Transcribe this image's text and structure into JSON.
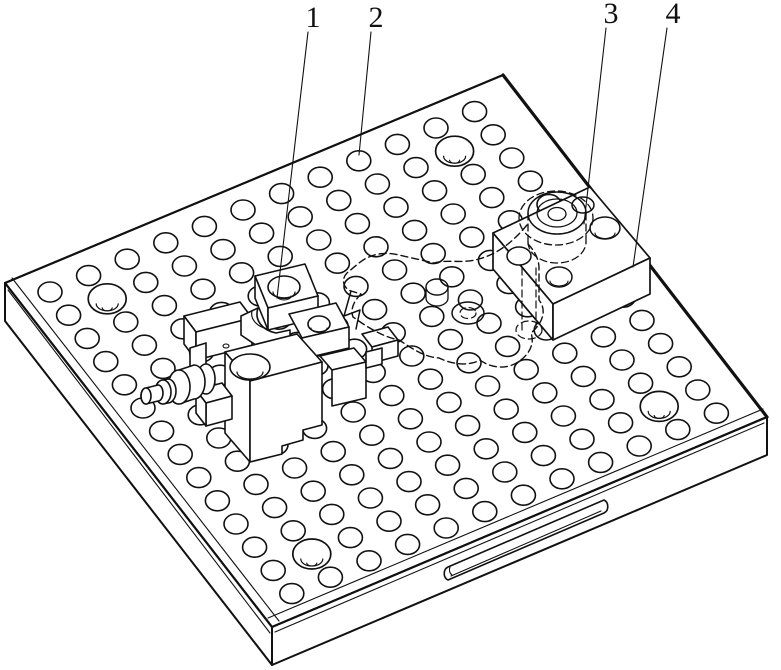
{
  "title_hidden": "",
  "colors": {
    "ink": "#111111",
    "paper": "#ffffff"
  },
  "callouts": [
    {
      "label": "1",
      "tx": 313,
      "ty": 27,
      "lx1": 308,
      "ly1": 32,
      "lx2": 277,
      "ly2": 298
    },
    {
      "label": "2",
      "tx": 376,
      "ty": 27,
      "lx1": 371,
      "ly1": 32,
      "lx2": 359,
      "ly2": 155
    },
    {
      "label": "3",
      "tx": 611,
      "ty": 23,
      "lx1": 606,
      "ly1": 28,
      "lx2": 584,
      "ly2": 224
    },
    {
      "label": "4",
      "tx": 673,
      "ty": 23,
      "lx1": 667,
      "ly1": 28,
      "lx2": 633,
      "ly2": 267
    }
  ],
  "figure": {
    "canvas": {
      "w": 781,
      "h": 670
    },
    "plate": {
      "top": [
        [
          5,
          283
        ],
        [
          503,
          75
        ],
        [
          767,
          417
        ],
        [
          272,
          627
        ]
      ],
      "bottom": [
        [
          5,
          321
        ],
        [
          272,
          665
        ],
        [
          767,
          455
        ]
      ],
      "edge_widths": {
        "lt": 2.1,
        "tr": 3.2,
        "rf": 2.1,
        "fl": 2.1
      },
      "chamfer_fl": [
        8,
        290,
        270,
        633
      ],
      "chamfer_fr": [
        275,
        632,
        764,
        423
      ],
      "inset_fl": [
        12,
        278,
        279,
        621
      ],
      "inset_fr": [
        268,
        618,
        763,
        409
      ]
    },
    "holes": {
      "origin": [
        50,
        292
      ],
      "a": [
        38.6,
        -16.4
      ],
      "c": [
        18.6,
        23.2
      ],
      "iMin": -10,
      "iMax": 13,
      "jMin": 0,
      "jMax": 13,
      "rx": 12,
      "ry": 10,
      "clip": {
        "L": [
          5,
          283
        ],
        "A": [
          498,
          -208
        ],
        "B": [
          264,
          342
        ],
        "sMin": 0.035,
        "sMax": 0.965,
        "tMin": 0.05,
        "tMax": 0.955
      },
      "large": [
        [
          1,
          1
        ],
        [
          10,
          1
        ],
        [
          1,
          12
        ],
        [
          10,
          12
        ]
      ],
      "largeRx": 19,
      "largeRy": 15
    },
    "shapes": [
      {
        "name": "side-slot-outline",
        "kind": "path",
        "d": "M448,567 L604,500 A6,7 0 0 1 604,513 L448,580 A6,7 0 0 1 448,567 Z",
        "f": "#ffffff",
        "w": 1.6
      },
      {
        "name": "side-slot-depth-line",
        "kind": "path",
        "d": "M451,576 L601,511",
        "w": 1.1
      },
      {
        "name": "side-slot-cap-arc",
        "kind": "path",
        "d": "M452,575 A5,6 0 0 1 450,567",
        "w": 1.1
      },
      {
        "name": "clamp-rear-base-top",
        "kind": "poly",
        "p": "184,316 240,302 252,318 196,332",
        "f": "#ffffff",
        "w": 1.6
      },
      {
        "name": "clamp-rear-base-left",
        "kind": "poly",
        "p": "184,316 196,332 196,360 184,344",
        "f": "#ffffff",
        "w": 1.6
      },
      {
        "name": "clamp-rear-base-front",
        "kind": "poly",
        "p": "196,332 252,318 252,346 196,360",
        "f": "#ffffff",
        "w": 1.6
      },
      {
        "name": "clamp-boss-a-top",
        "kind": "poly",
        "p": "255,276 305,264 318,296 268,308",
        "f": "#ffffff",
        "w": 1.6
      },
      {
        "name": "clamp-boss-a-left",
        "kind": "poly",
        "p": "255,276 268,308 268,330 255,298",
        "f": "#ffffff",
        "w": 1.6
      },
      {
        "name": "clamp-boss-a-front",
        "kind": "poly",
        "p": "268,308 318,296 318,318 268,330",
        "f": "#ffffff",
        "w": 1.6
      },
      {
        "name": "clamp-boss-a-hole",
        "kind": "ellipse",
        "cx": 284,
        "cy": 287,
        "rx": 16,
        "ry": 11,
        "f": "#ffffff",
        "w": 1.6
      },
      {
        "name": "clamp-boss-a-hole-recess",
        "kind": "path",
        "d": "M273,292 A11,6.5 0 0 0 295,292",
        "w": 1.2
      },
      {
        "name": "clamp-boss-a-hole-bore",
        "kind": "path",
        "d": "M277,296 A7,4 0 0 0 291,296",
        "w": 1.1
      },
      {
        "name": "clamp-boss-b-top",
        "kind": "poly",
        "p": "289,314 336,303 349,327 302,338",
        "f": "#ffffff",
        "w": 1.6
      },
      {
        "name": "clamp-boss-b-front",
        "kind": "poly",
        "p": "302,338 349,327 349,348 302,359",
        "f": "#ffffff",
        "w": 1.6
      },
      {
        "name": "clamp-boss-b-hole",
        "kind": "ellipse",
        "cx": 319,
        "cy": 324,
        "rx": 11,
        "ry": 8,
        "f": "#ffffff",
        "w": 1.6
      },
      {
        "name": "clamp-boss-b-hole-recess",
        "kind": "path",
        "d": "M311,328 A8,4.5 0 0 0 327,328",
        "w": 1.1
      },
      {
        "name": "clamp-saddle",
        "kind": "path",
        "d": "M241,316 L258,308 C254,320 262,330 276,333 L290,330 L290,344 L266,352 L241,335 Z",
        "f": "#ffffff",
        "w": 1.6
      },
      {
        "name": "clamp-saddle-arc",
        "kind": "path",
        "d": "M252,311 C250,319 257,327 268,329",
        "w": 1.2
      },
      {
        "name": "clamp-lug",
        "kind": "poly",
        "p": "190,348 206,343 206,392 190,397",
        "f": "#ffffff",
        "w": 1.6
      },
      {
        "name": "clamp-main-top",
        "kind": "poly",
        "p": "225,352 297,334 322,362 250,381",
        "f": "#ffffff",
        "w": 1.6
      },
      {
        "name": "clamp-main-left",
        "kind": "poly",
        "p": "225,352 250,381 250,462 225,433",
        "f": "#ffffff",
        "w": 1.6
      },
      {
        "name": "clamp-main-front",
        "kind": "path",
        "d": "M250,381 L322,362 L322,425 L303,430 L303,440 L282,446 L282,454 L250,462 Z",
        "f": "#ffffff",
        "w": 1.6
      },
      {
        "name": "clamp-main-hole",
        "kind": "ellipse",
        "cx": 250,
        "cy": 367,
        "rx": 20,
        "ry": 13,
        "f": "#ffffff",
        "w": 1.6
      },
      {
        "name": "clamp-main-hole-recess",
        "kind": "path",
        "d": "M237,372 A13,7 0 0 0 263,372",
        "w": 1.2
      },
      {
        "name": "clamp-set-screw",
        "kind": "ellipse",
        "cx": 226,
        "cy": 346,
        "rx": 3,
        "ry": 2,
        "f": "#ffffff",
        "w": 1.1
      },
      {
        "name": "clamp-step-top",
        "kind": "poly",
        "p": "320,356 354,348 366,362 332,370",
        "f": "#ffffff",
        "w": 1.6
      },
      {
        "name": "clamp-step-front",
        "kind": "poly",
        "p": "332,370 366,362 366,398 332,406",
        "f": "#ffffff",
        "w": 1.6
      },
      {
        "name": "clamp-bracket-top",
        "kind": "poly",
        "p": "196,390 222,383 232,396 206,403",
        "f": "#ffffff",
        "w": 1.6
      },
      {
        "name": "clamp-bracket-front",
        "kind": "poly",
        "p": "206,403 232,396 232,419 206,426",
        "f": "#ffffff",
        "w": 1.6
      },
      {
        "name": "clamp-bracket-left",
        "kind": "poly",
        "p": "196,390 206,403 206,426 196,413",
        "f": "#ffffff",
        "w": 1.6
      },
      {
        "name": "screw-washer",
        "kind": "ellipse",
        "cx": 206,
        "cy": 379,
        "rx": 9,
        "ry": 15,
        "f": "#ffffff",
        "w": 1.6
      },
      {
        "name": "screw-collar-body",
        "kind": "path",
        "d": "M179,370 L194,365 A11,17 0 0 1 194,399 L179,404 A11,17 0 0 1 179,370 Z",
        "f": "#ffffff",
        "w": 1.6
      },
      {
        "name": "screw-collar-end",
        "kind": "ellipse",
        "cx": 179,
        "cy": 387,
        "rx": 11,
        "ry": 17,
        "f": "#ffffff",
        "w": 1.6
      },
      {
        "name": "screw-ring-body",
        "kind": "path",
        "d": "M163,380 L168,379 A8,12 0 0 1 168,403 L163,404 A8,12 0 0 1 163,380 Z",
        "f": "#ffffff",
        "w": 1.6
      },
      {
        "name": "screw-ring-end",
        "kind": "ellipse",
        "cx": 163,
        "cy": 392,
        "rx": 8,
        "ry": 12,
        "f": "#ffffff",
        "w": 1.6
      },
      {
        "name": "screw-shaft-body",
        "kind": "path",
        "d": "M146,388 L158,385 A5,8 0 0 1 158,401 L146,404 A5,8 0 0 1 146,388 Z",
        "f": "#ffffff",
        "w": 1.6
      },
      {
        "name": "screw-shaft-end",
        "kind": "ellipse",
        "cx": 146,
        "cy": 396,
        "rx": 5,
        "ry": 8,
        "f": "#ffffff",
        "w": 1.6
      },
      {
        "name": "clamp-jaw-top",
        "kind": "poly",
        "p": "362,334 388,327 398,340 372,347",
        "f": "#ffffff",
        "w": 1.6
      },
      {
        "name": "clamp-jaw-front",
        "kind": "poly",
        "p": "372,347 398,340 398,356 372,363",
        "f": "#ffffff",
        "w": 1.6
      },
      {
        "name": "clamp-jaw-foot",
        "kind": "poly",
        "p": "366,352 382,348 382,364 366,368",
        "f": "#ffffff",
        "w": 1.6
      },
      {
        "name": "riser-block-top",
        "kind": "poly",
        "p": "493,233 590,187 650,258 553,304",
        "f": "#ffffff",
        "w": 1.7
      },
      {
        "name": "riser-block-left",
        "kind": "poly",
        "p": "493,233 553,304 553,340 493,269",
        "f": "#ffffff",
        "w": 1.7
      },
      {
        "name": "riser-block-right",
        "kind": "poly",
        "p": "553,304 650,258 650,294 553,340",
        "f": "#ffffff",
        "w": 1.7
      },
      {
        "name": "riser-hole-1",
        "kind": "ellipse",
        "cx": 519,
        "cy": 256,
        "rx": 12,
        "ry": 9,
        "f": "#ffffff",
        "w": 1.5
      },
      {
        "name": "riser-hole-2",
        "kind": "ellipse",
        "cx": 559,
        "cy": 277,
        "rx": 13,
        "ry": 10,
        "f": "#ffffff",
        "w": 1.5
      },
      {
        "name": "riser-hole-2-recess",
        "kind": "path",
        "d": "M550,281 A9,5 0 0 0 568,281",
        "w": 1.1
      },
      {
        "name": "riser-hole-3",
        "kind": "ellipse",
        "cx": 605,
        "cy": 228,
        "rx": 15,
        "ry": 11,
        "f": "#ffffff",
        "w": 1.5
      },
      {
        "name": "riser-hole-3-recess",
        "kind": "path",
        "d": "M595,233 A10,5.5 0 0 0 615,233",
        "w": 1.1
      },
      {
        "name": "riser-hole-4",
        "kind": "ellipse",
        "cx": 583,
        "cy": 205,
        "rx": 11,
        "ry": 8,
        "f": "#ffffff",
        "w": 1.5
      },
      {
        "name": "workpiece-spotface",
        "kind": "ellipse",
        "cx": 556,
        "cy": 218,
        "rx": 37,
        "ry": 27,
        "dash": true,
        "w": 1.3
      },
      {
        "name": "workpiece-boss-outer",
        "kind": "ellipse",
        "cx": 557,
        "cy": 213,
        "rx": 29,
        "ry": 21,
        "w": 1.5
      },
      {
        "name": "workpiece-boss-mid",
        "kind": "ellipse",
        "cx": 557,
        "cy": 213,
        "rx": 20,
        "ry": 14,
        "w": 1.3
      },
      {
        "name": "workpiece-boss-bore",
        "kind": "ellipse",
        "cx": 557,
        "cy": 214,
        "rx": 9,
        "ry": 6.5,
        "w": 1.3
      },
      {
        "name": "workpiece-boss-side-left",
        "kind": "path",
        "d": "M528,213 L528,242",
        "dash": true,
        "w": 1.3
      },
      {
        "name": "workpiece-boss-side-right",
        "kind": "path",
        "d": "M586,213 L586,242",
        "dash": true,
        "w": 1.3
      },
      {
        "name": "workpiece-boss-bottom",
        "kind": "path",
        "d": "M528,242 A29,21 0 0 0 586,242",
        "dash": true,
        "w": 1.3
      },
      {
        "name": "workpiece-body-outline",
        "kind": "path",
        "d": "M527,225 C512,243 497,254 479,259 C462,264 448,259 434,263 L399,255 C382,251 369,255 359,263 L347,273 C341,279 343,288 351,291 L361,294 C354,301 350,309 353,317 C367,327 383,337 399,340 C413,349 424,357 439,358 C454,365 469,366 480,360 C492,369 508,369 518,362 C529,355 535,344 531,333 C543,323 547,310 539,300 L539,268 C539,259 534,250 528,244",
        "dash": true,
        "w": 1.4
      },
      {
        "name": "workpiece-lobe-hole",
        "kind": "ellipse",
        "cx": 468,
        "cy": 313,
        "rx": 16,
        "ry": 11,
        "w": 1.5
      },
      {
        "name": "workpiece-lobe-bore",
        "kind": "ellipse",
        "cx": 468,
        "cy": 313,
        "rx": 8,
        "ry": 5.5,
        "dash": true,
        "w": 1.2
      },
      {
        "name": "workpiece-stub-top",
        "kind": "ellipse",
        "cx": 437,
        "cy": 287,
        "rx": 11,
        "ry": 8,
        "w": 1.4
      },
      {
        "name": "workpiece-stub-sides",
        "kind": "path",
        "d": "M426,287 L426,298 M448,287 L448,298",
        "w": 1.3
      },
      {
        "name": "workpiece-stub-bottom",
        "kind": "path",
        "d": "M426,298 A11,8 0 0 0 448,298",
        "w": 1.3
      },
      {
        "name": "workpiece-hook",
        "kind": "path",
        "d": "M351,291 L344,316 L360,310 L356,329",
        "w": 1.5
      },
      {
        "name": "workpiece-hidden-drop-1",
        "kind": "path",
        "d": "M522,268 L522,330",
        "dash": true,
        "w": 1.2
      },
      {
        "name": "workpiece-hidden-drop-2",
        "kind": "path",
        "d": "M536,268 L536,326",
        "dash": true,
        "w": 1.2
      },
      {
        "name": "workpiece-hidden-foot",
        "kind": "ellipse",
        "cx": 529,
        "cy": 330,
        "rx": 13,
        "ry": 9,
        "dash": true,
        "w": 1.2
      }
    ]
  }
}
